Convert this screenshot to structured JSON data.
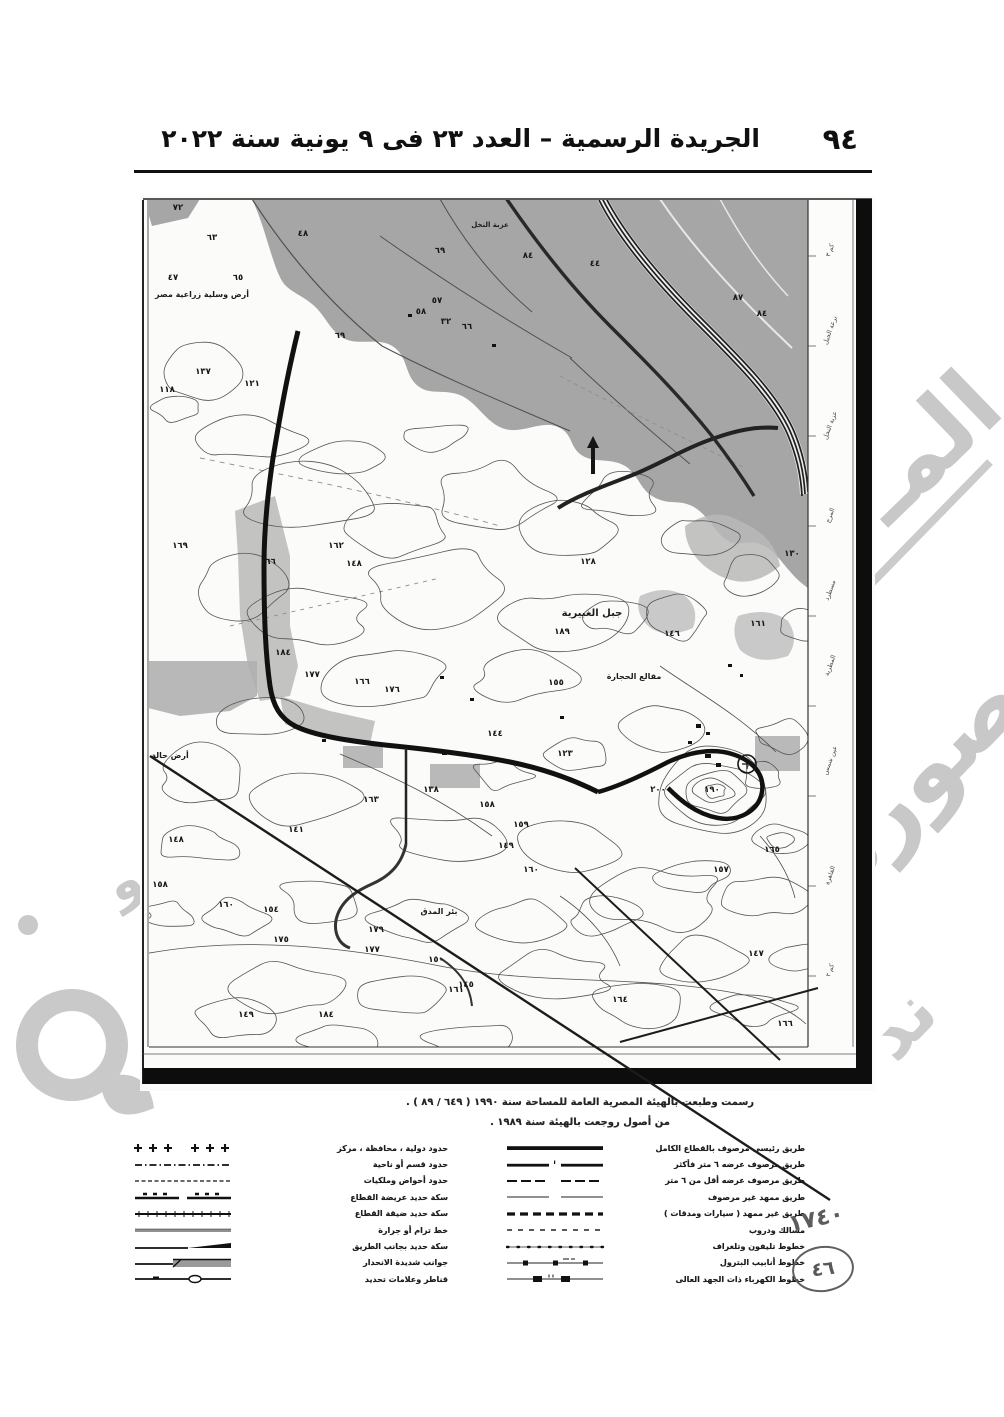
{
  "header": {
    "page_number": "٩٤",
    "title": "الجريدة الرسمية – العدد ٢٣ فى ٩ يونية سنة ٢٠٢٢"
  },
  "map": {
    "captions": [
      "رسمت وطبعت بالهيئة المصرية العامة للمساحة سنة ١٩٩٠ ( ٦٤٩ / ٨٩ ) .",
      "من أصول روجعت بالهيئة سنة ١٩٨٩ ."
    ],
    "place_labels": [
      {
        "text": "أرض وسلية زراعية مصر",
        "x": 62,
        "y": 101,
        "size": 8
      },
      {
        "text": "عزبة النخل",
        "x": 350,
        "y": 31,
        "size": 7
      },
      {
        "text": "جبل الغبيرية",
        "x": 452,
        "y": 420,
        "size": 10
      },
      {
        "text": "مقالع الحجارة",
        "x": 494,
        "y": 483,
        "size": 8
      },
      {
        "text": "أرض حالة",
        "x": 30,
        "y": 562,
        "size": 8
      },
      {
        "text": "بئر المدق",
        "x": 299,
        "y": 718,
        "size": 8
      }
    ],
    "spot_heights": [
      {
        "v": "٧٢",
        "x": 38,
        "y": 14
      },
      {
        "v": "٦٣",
        "x": 72,
        "y": 44
      },
      {
        "v": "٤٧",
        "x": 33,
        "y": 84
      },
      {
        "v": "٦٥",
        "x": 98,
        "y": 84
      },
      {
        "v": "٤٨",
        "x": 163,
        "y": 40
      },
      {
        "v": "٦٩",
        "x": 300,
        "y": 57
      },
      {
        "v": "٨٤",
        "x": 388,
        "y": 62
      },
      {
        "v": "٤٤",
        "x": 455,
        "y": 70
      },
      {
        "v": "٨٧",
        "x": 598,
        "y": 104
      },
      {
        "v": "٨٤",
        "x": 622,
        "y": 120
      },
      {
        "v": "٥٧",
        "x": 297,
        "y": 107
      },
      {
        "v": "٥٨",
        "x": 281,
        "y": 118
      },
      {
        "v": "٣٢",
        "x": 306,
        "y": 128
      },
      {
        "v": "٦٦",
        "x": 327,
        "y": 133
      },
      {
        "v": "٦٩",
        "x": 200,
        "y": 142
      },
      {
        "v": "١٣٧",
        "x": 63,
        "y": 178
      },
      {
        "v": "١١٨",
        "x": 27,
        "y": 196
      },
      {
        "v": "١٢١",
        "x": 112,
        "y": 190
      },
      {
        "v": "١٦٩",
        "x": 40,
        "y": 352
      },
      {
        "v": "١٦٦",
        "x": 128,
        "y": 368
      },
      {
        "v": "١٦٢",
        "x": 196,
        "y": 352
      },
      {
        "v": "١٤٨",
        "x": 214,
        "y": 370
      },
      {
        "v": "١٢٨",
        "x": 448,
        "y": 368
      },
      {
        "v": "١٦١",
        "x": 618,
        "y": 430
      },
      {
        "v": "١٨٩",
        "x": 422,
        "y": 438
      },
      {
        "v": "١٥٥",
        "x": 416,
        "y": 489
      },
      {
        "v": "١٧٦",
        "x": 252,
        "y": 496
      },
      {
        "v": "١٦٦",
        "x": 222,
        "y": 488
      },
      {
        "v": "١٨٤",
        "x": 143,
        "y": 459
      },
      {
        "v": "١٧٧",
        "x": 172,
        "y": 481
      },
      {
        "v": "١٤٦",
        "x": 532,
        "y": 440
      },
      {
        "v": "١٣٠",
        "x": 652,
        "y": 360
      },
      {
        "v": "١٢٣",
        "x": 425,
        "y": 560
      },
      {
        "v": "١٤٤",
        "x": 355,
        "y": 540
      },
      {
        "v": "١٣٨",
        "x": 291,
        "y": 596
      },
      {
        "v": "١٦٣",
        "x": 231,
        "y": 606
      },
      {
        "v": "١٥٨",
        "x": 347,
        "y": 611
      },
      {
        "v": "١٥٩",
        "x": 381,
        "y": 631
      },
      {
        "v": "١٤٩",
        "x": 366,
        "y": 652
      },
      {
        "v": "١٦٠",
        "x": 391,
        "y": 676
      },
      {
        "v": "١٤١",
        "x": 156,
        "y": 636
      },
      {
        "v": "١٤٨",
        "x": 36,
        "y": 646
      },
      {
        "v": "١٥٨",
        "x": 20,
        "y": 691
      },
      {
        "v": "١٦٠",
        "x": 86,
        "y": 711
      },
      {
        "v": "١٥٤",
        "x": 131,
        "y": 716
      },
      {
        "v": "١٧٥",
        "x": 141,
        "y": 746
      },
      {
        "v": "١٧٩",
        "x": 236,
        "y": 736
      },
      {
        "v": "١٧٧",
        "x": 232,
        "y": 756
      },
      {
        "v": "١٦١",
        "x": 316,
        "y": 796
      },
      {
        "v": "١٨٤",
        "x": 186,
        "y": 821
      },
      {
        "v": "١٤٩",
        "x": 106,
        "y": 821
      },
      {
        "v": "١٦٤",
        "x": 480,
        "y": 806
      },
      {
        "v": "١٤٧",
        "x": 616,
        "y": 760
      },
      {
        "v": "١٥٧",
        "x": 581,
        "y": 676
      },
      {
        "v": "١٦٥",
        "x": 632,
        "y": 656
      },
      {
        "v": "١٩٠",
        "x": 572,
        "y": 596
      },
      {
        "v": "٢٠٠",
        "x": 518,
        "y": 596
      },
      {
        "v": "١٤٥",
        "x": 326,
        "y": 791
      },
      {
        "v": "١٥٠",
        "x": 296,
        "y": 766
      },
      {
        "v": "١٦٦",
        "x": 645,
        "y": 830
      },
      {
        "v": "١٤٠٠",
        "x": 22,
        "y": 866
      },
      {
        "v": "١٦٢٠",
        "x": 656,
        "y": 866
      }
    ],
    "margin_labels": [
      {
        "text": "كم ٣",
        "y": 55
      },
      {
        "text": "ترعة الجبل",
        "y": 135
      },
      {
        "text": "عزبة النخل",
        "y": 230
      },
      {
        "text": "المرج",
        "y": 320
      },
      {
        "text": "مسطرد",
        "y": 395
      },
      {
        "text": "المطرية",
        "y": 470
      },
      {
        "text": "عين شمس",
        "y": 565
      },
      {
        "text": "القاهرة",
        "y": 680
      },
      {
        "text": "كم ٢",
        "y": 775
      }
    ]
  },
  "legend": {
    "groups": [
      {
        "rows": [
          {
            "symbol": "crosses",
            "label": "حدود دولية ، محافظة ، مركز"
          },
          {
            "symbol": "dash-dot",
            "label": "حدود قسم أو ناحية"
          },
          {
            "symbol": "fine-dash",
            "label": "حدود أحواض وملكيات"
          },
          {
            "symbol": "double-tick",
            "label": "سكة حديد عريضة القطاع"
          },
          {
            "symbol": "tick-line",
            "label": "سكة حديد ضيقة القطاع"
          },
          {
            "symbol": "thin-line",
            "label": "خط ترام أو جرارة"
          },
          {
            "symbol": "embankment",
            "label": "سكة حديد بجانب الطريق"
          },
          {
            "symbol": "cutting",
            "label": "جوانب شديدة الانحدار"
          },
          {
            "symbol": "culvert",
            "label": "قناطر وعلامات تحديد"
          }
        ]
      },
      {
        "rows": [
          {
            "symbol": "thick-bar",
            "label": "طريق رئيسى مرصوف بالقطاع الكامل"
          },
          {
            "symbol": "double-bar-gap",
            "label": "طريق مرصوف عرضه ٦ متر فأكثر"
          },
          {
            "symbol": "dash-gap",
            "label": "طريق مرصوف عرضه أقل من ٦ متر"
          },
          {
            "symbol": "thin-gap",
            "label": "طريق ممهد غير مرصوف"
          },
          {
            "symbol": "bold-dashes",
            "label": "طريق غير ممهد ( سيارات ومدقات )"
          },
          {
            "symbol": "short-dashes",
            "label": "مسالك ودروب"
          },
          {
            "symbol": "dot-diamond",
            "label": "خطوط تليفون وتلغراف"
          },
          {
            "symbol": "squares-line",
            "label": "خطوط أنابيب البترول"
          },
          {
            "symbol": "rects-line",
            "label": "خطوط الكهرباء ذات الجهد العالى"
          }
        ]
      }
    ]
  },
  "annotations": {
    "handwritten_number": "١٧٤٠",
    "circled_number": "٤٦"
  },
  "watermark": {
    "fragments": [
      "المـ",
      "صورة",
      "ند",
      "و"
    ]
  },
  "colors": {
    "shade_dark": "#a6a6a6",
    "shade_light": "#b9b9b9",
    "ink": "#141414",
    "watermark_gray": "#c8c8c8"
  }
}
